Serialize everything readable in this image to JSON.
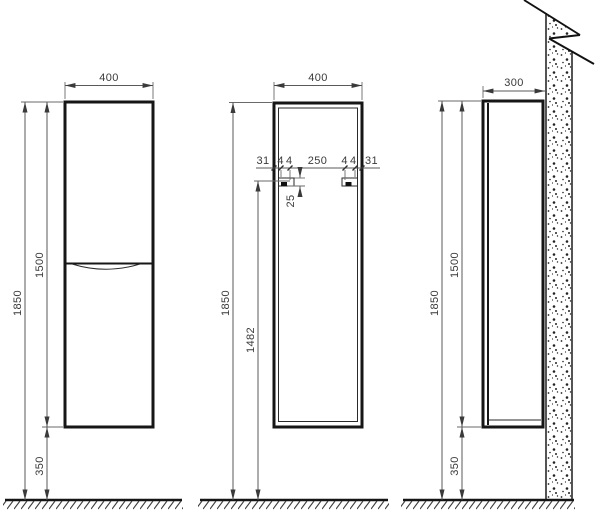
{
  "page": {
    "background": "#ffffff",
    "line_color": "#161616",
    "dim_line_color": "#5a5a5a",
    "text_color": "#3a3a3a"
  },
  "views": {
    "front": {
      "width": "400",
      "total_height": "1850",
      "cabinet_height": "1500",
      "floor_clearance": "350"
    },
    "carcass": {
      "width": "400",
      "chain": {
        "left_margin": "31",
        "left_inset": "44",
        "center_span": "250",
        "right_inset": "44",
        "right_margin": "31"
      },
      "hanger_offset": "25",
      "total_height": "1850",
      "hanger_hole_height": "1482"
    },
    "side": {
      "depth": "300",
      "total_height": "1850",
      "cabinet_height": "1500",
      "floor_clearance": "350"
    }
  }
}
